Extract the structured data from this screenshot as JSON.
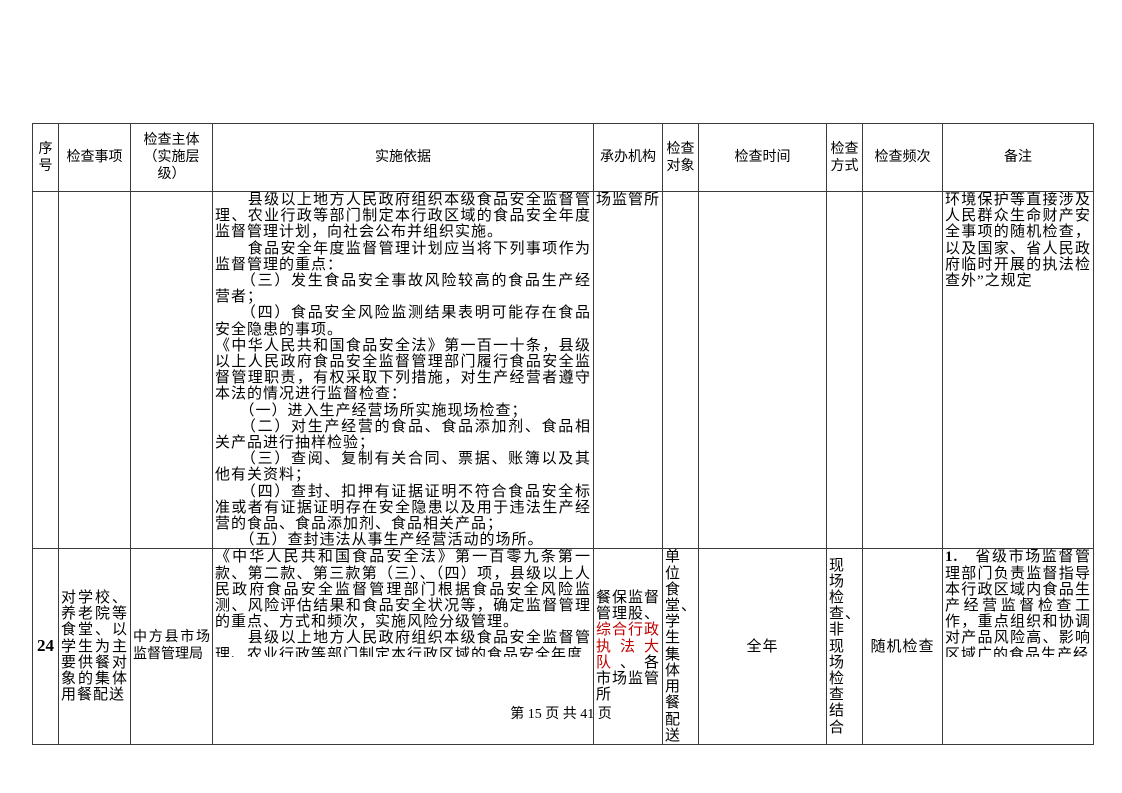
{
  "footer": {
    "text": "第 15 页 共 41 页"
  },
  "colors": {
    "highlight_red": "#c00000",
    "border": "#3b3b3b",
    "text": "#000000",
    "background": "#ffffff"
  },
  "table": {
    "headers": [
      "序号",
      "检查事项",
      "检查主体（实施层级）",
      "实施依据",
      "承办机构",
      "检查对象",
      "检查时间",
      "检查方式",
      "检查频次",
      "备注"
    ],
    "row_prev": {
      "agency": "场监管所",
      "basis": [
        "　　县级以上地方人民政府组织本级食品安全监督管理、农业行政等部门制定本行政区域的食品安全年度监督管理计划，向社会公布并组织实施。",
        "　　食品安全年度监督管理计划应当将下列事项作为监督管理的重点：",
        "　　（三）发生食品安全事故风险较高的食品生产经营者；",
        "　　（四）食品安全风险监测结果表明可能存在食品安全隐患的事项。",
        "《中华人民共和国食品安全法》第一百一十条，县级以上人民政府食品安全监督管理部门履行食品安全监督管理职责，有权采取下列措施，对生产经营者遵守本法的情况进行监督检查：",
        "　　（一）进入生产经营场所实施现场检查；",
        "　　（二）对生产经营的食品、食品添加剂、食品相关产品进行抽样检验；",
        "　　（三）查阅、复制有关合同、票据、账簿以及其他有关资料；",
        "　　（四）查封、扣押有证据证明不符合食品安全标准或者有证据证明存在安全隐患以及用于违法生产经营的食品、食品添加剂、食品相关产品；",
        "　　（五）查封违法从事生产经营活动的场所。"
      ],
      "remark": "环境保护等直接涉及人民群众生命财产安全事项的随机检查，以及国家、省人民政府临时开展的执法检查外”之规定"
    },
    "row24": {
      "seq": "24",
      "item": "对学校、养老院等食堂、以学生为主要供餐对象的集体用餐配送",
      "subject": "中方县市场监督管理局",
      "basis": [
        "《中华人民共和国食品安全法》第一百零九条第一款、第二款、第三款第（三）、（四）项，县级以上人民政府食品安全监督管理部门根据食品安全风险监测、风险评估结果和食品安全状况等，确定监督管理的重点、方式和频次，实施风险分级管理。",
        "　　县级以上地方人民政府组织本级食品安全监督管理、农业行政等部门制定本行政区域的食品安全年度"
      ],
      "agency": {
        "part1": "餐保监督管理股、",
        "highlight": "综合行政执法大队",
        "part2": "、各市场监管所"
      },
      "target": "单位食堂、学生集体用餐配送",
      "time": "全年",
      "method": "现场检查、非现场检查结合",
      "frequency": "随机检查",
      "remark": {
        "number": "1.",
        "text": "　省级市场监督管理部门负责监督指导本行政区域内食品生产经营监督检查工作，重点组织和协调对产品风险高、影响区域广的食品生产经"
      }
    }
  }
}
